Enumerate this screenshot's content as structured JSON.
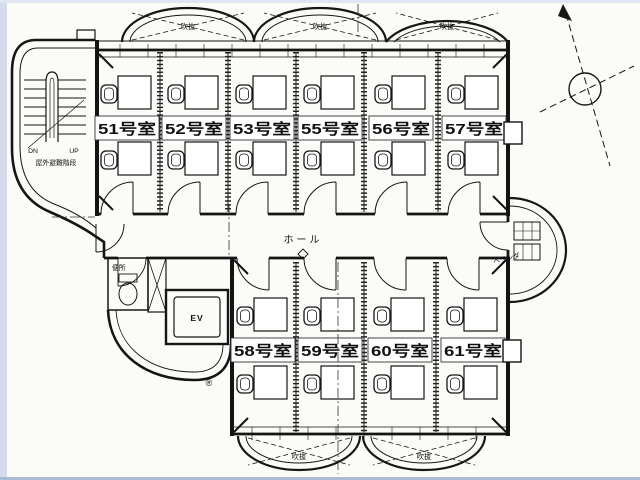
{
  "plan": {
    "rooms_top": [
      {
        "label": "51号室"
      },
      {
        "label": "52号室"
      },
      {
        "label": "53号室"
      },
      {
        "label": "55号室"
      },
      {
        "label": "56号室"
      },
      {
        "label": "57号室"
      }
    ],
    "rooms_bottom": [
      {
        "label": "58号室"
      },
      {
        "label": "59号室"
      },
      {
        "label": "60号室"
      },
      {
        "label": "61号室"
      }
    ],
    "hall_label": "ホール",
    "elevator_label": "EV",
    "toilet_label": "便所",
    "stairs": {
      "down_label": "DN",
      "up_label": "UP",
      "caption": "屋外避難階段"
    },
    "veranda_label": "ベランダ",
    "void_label": "吹抜",
    "registered_marker": "®",
    "colors": {
      "ink": "#1a1a1a",
      "paper": "#fbfbf8",
      "scan_edge": "#ccd7e6"
    }
  }
}
